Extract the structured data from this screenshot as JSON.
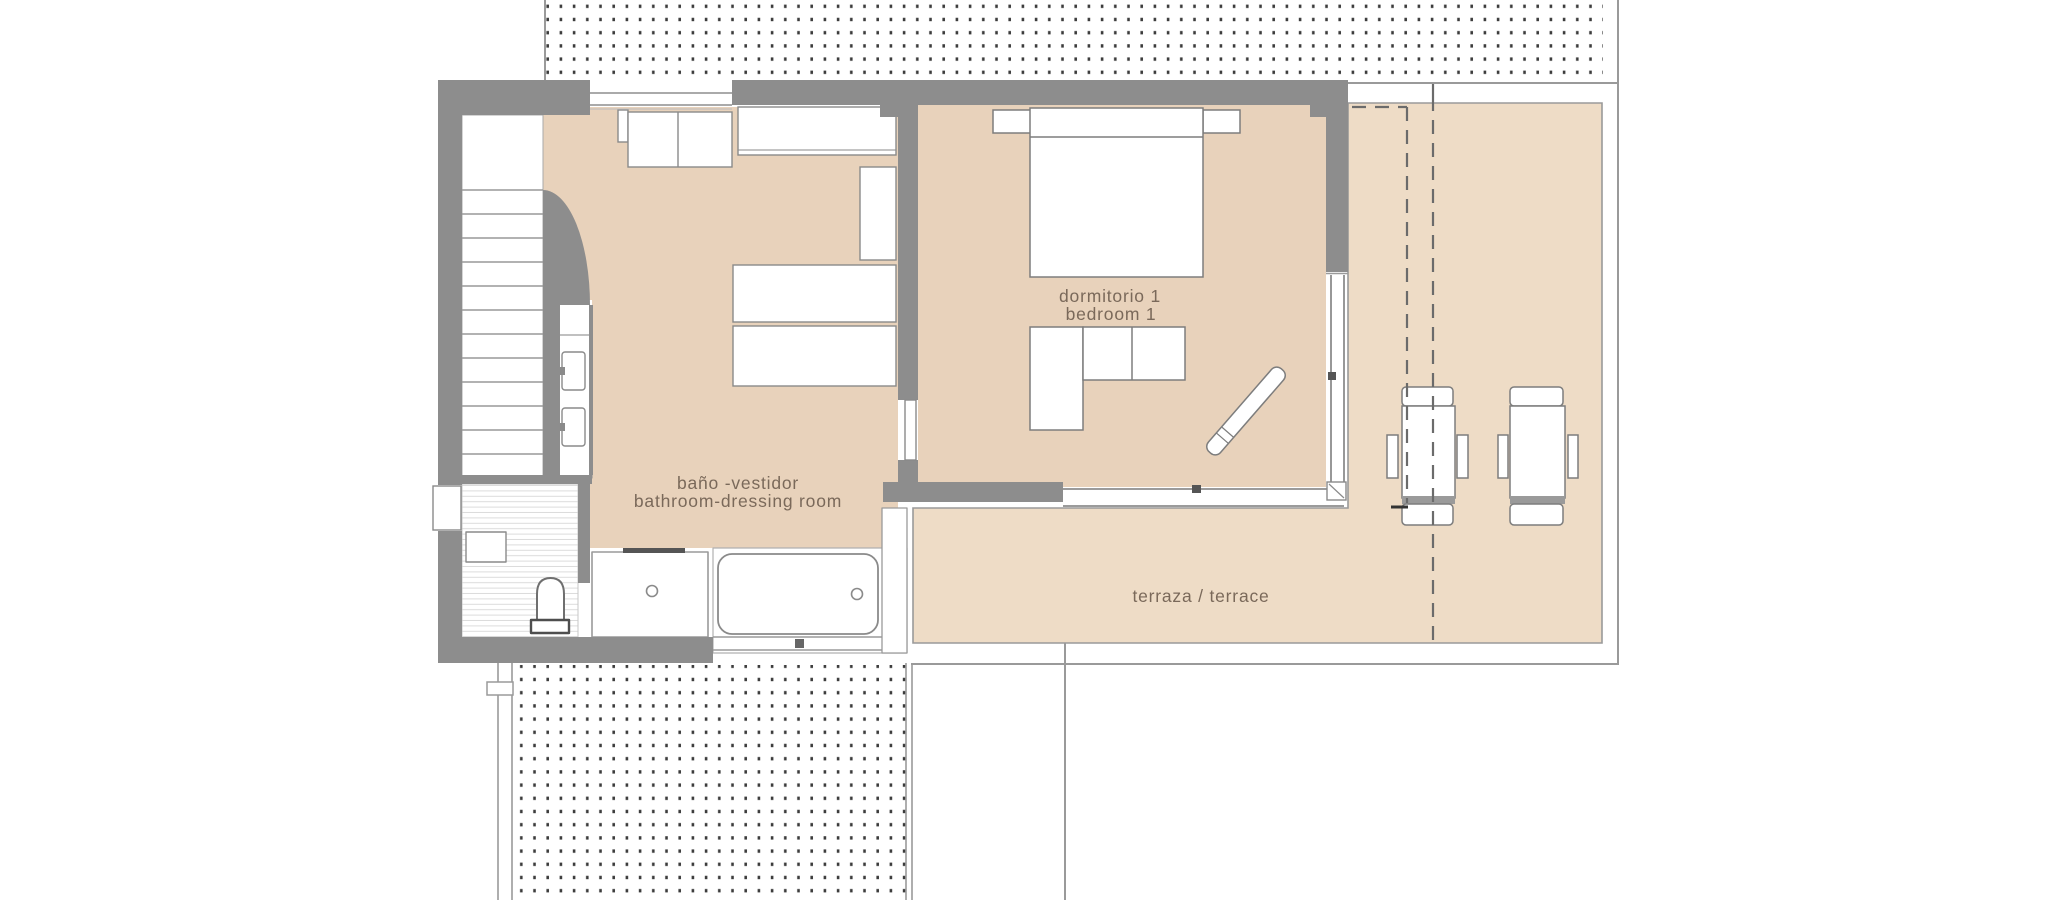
{
  "plan": {
    "kind": "architectural floor plan",
    "labels": {
      "bedroom_line1": "dormitorio 1",
      "bedroom_line2": "bedroom 1",
      "bathroom_line1": "baño -vestidor",
      "bathroom_line2": "bathroom-dressing room",
      "terrace": "terraza / terrace"
    },
    "rooms": [
      {
        "name_es": "dormitorio 1",
        "name_en": "bedroom 1"
      },
      {
        "name_es": "baño -vestidor",
        "name_en": "bathroom-dressing room"
      },
      {
        "name_es": "terraza",
        "name_en": "terrace"
      }
    ]
  },
  "colors": {
    "room_floor": "#e8d2bb",
    "terrace_floor": "#eedcc6",
    "wall": "#8d8d8d",
    "outline": "#9a9a9a",
    "dots": "#3c3c3c",
    "plank": "#dcdcdc",
    "label_text": "#7a695a",
    "fixture": "#8a8a8a"
  }
}
